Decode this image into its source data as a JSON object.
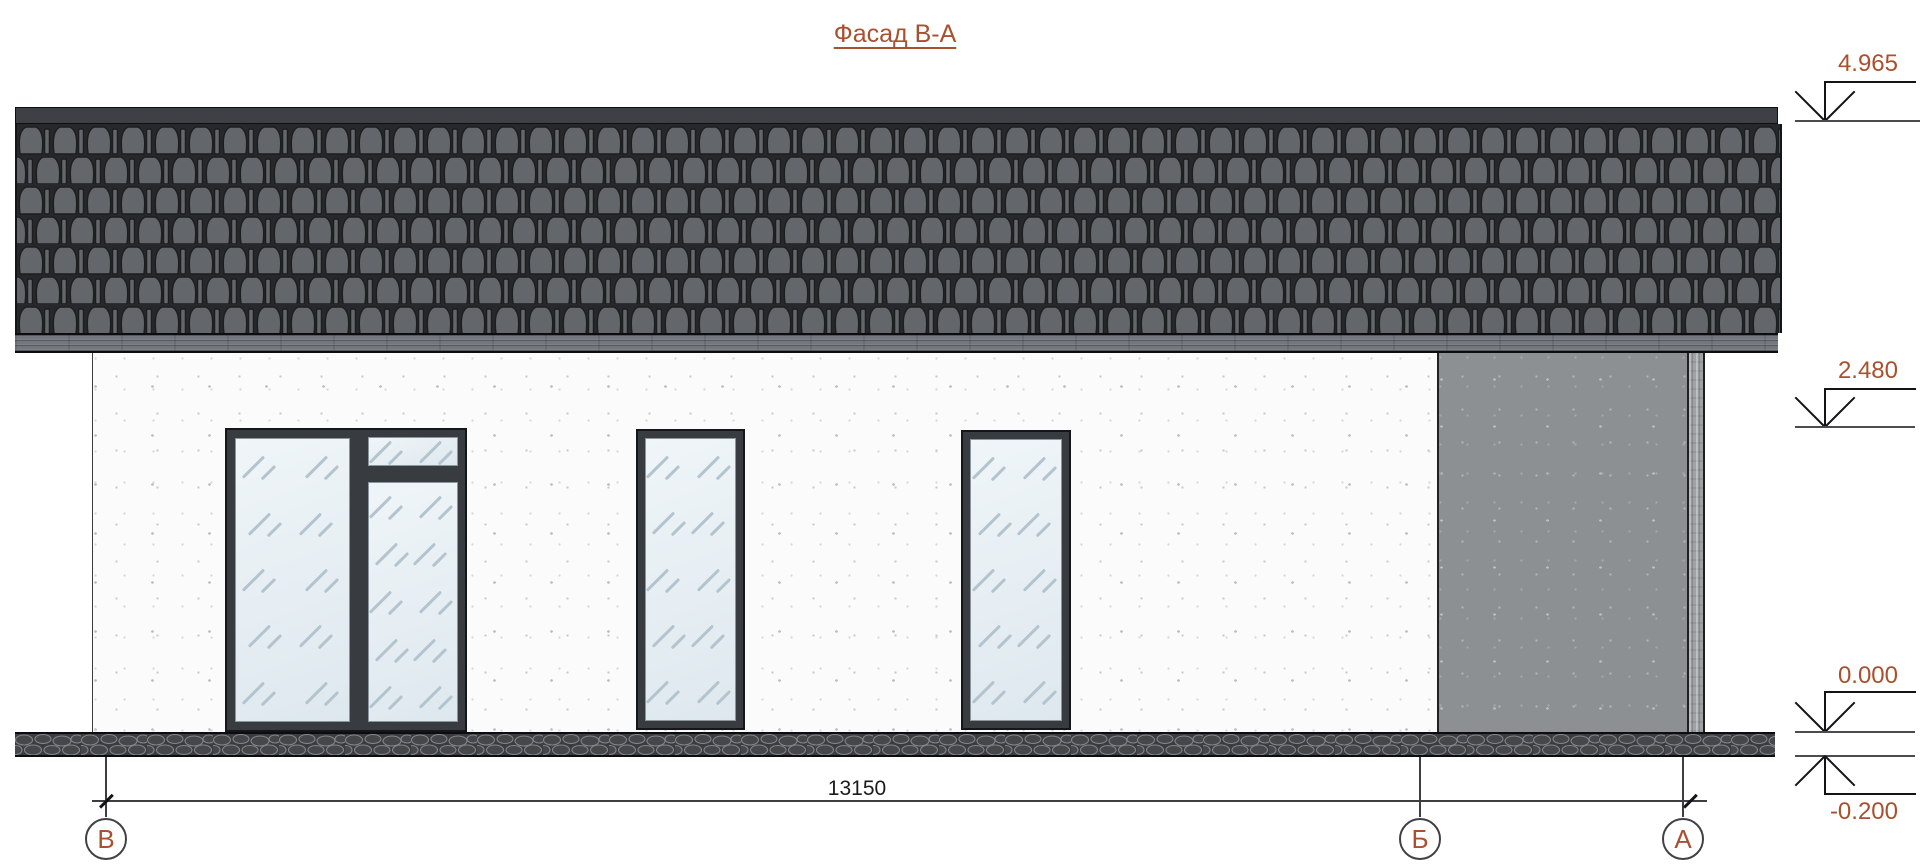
{
  "title": "Фасад В-А",
  "dimension": {
    "overall": "13150"
  },
  "elevations": [
    {
      "value": "4.965"
    },
    {
      "value": "2.480"
    },
    {
      "value": "0.000"
    },
    {
      "value": "-0.200"
    }
  ],
  "axes": [
    {
      "label": "В"
    },
    {
      "label": "Б"
    },
    {
      "label": "А"
    }
  ],
  "colors": {
    "accent_text": "#a9512e",
    "roof_tile": "#63666a",
    "roof_ridge": "#3d4044",
    "fascia": "#74787e",
    "wall_stucco": "#fbfbfb",
    "wall_stone": "#8d9093",
    "corner_column": "#a0a3a6",
    "plinth": "#3a3c3f",
    "window_frame": "#383c40",
    "glass": "#e9f0f4",
    "line": "#3c3e40"
  }
}
